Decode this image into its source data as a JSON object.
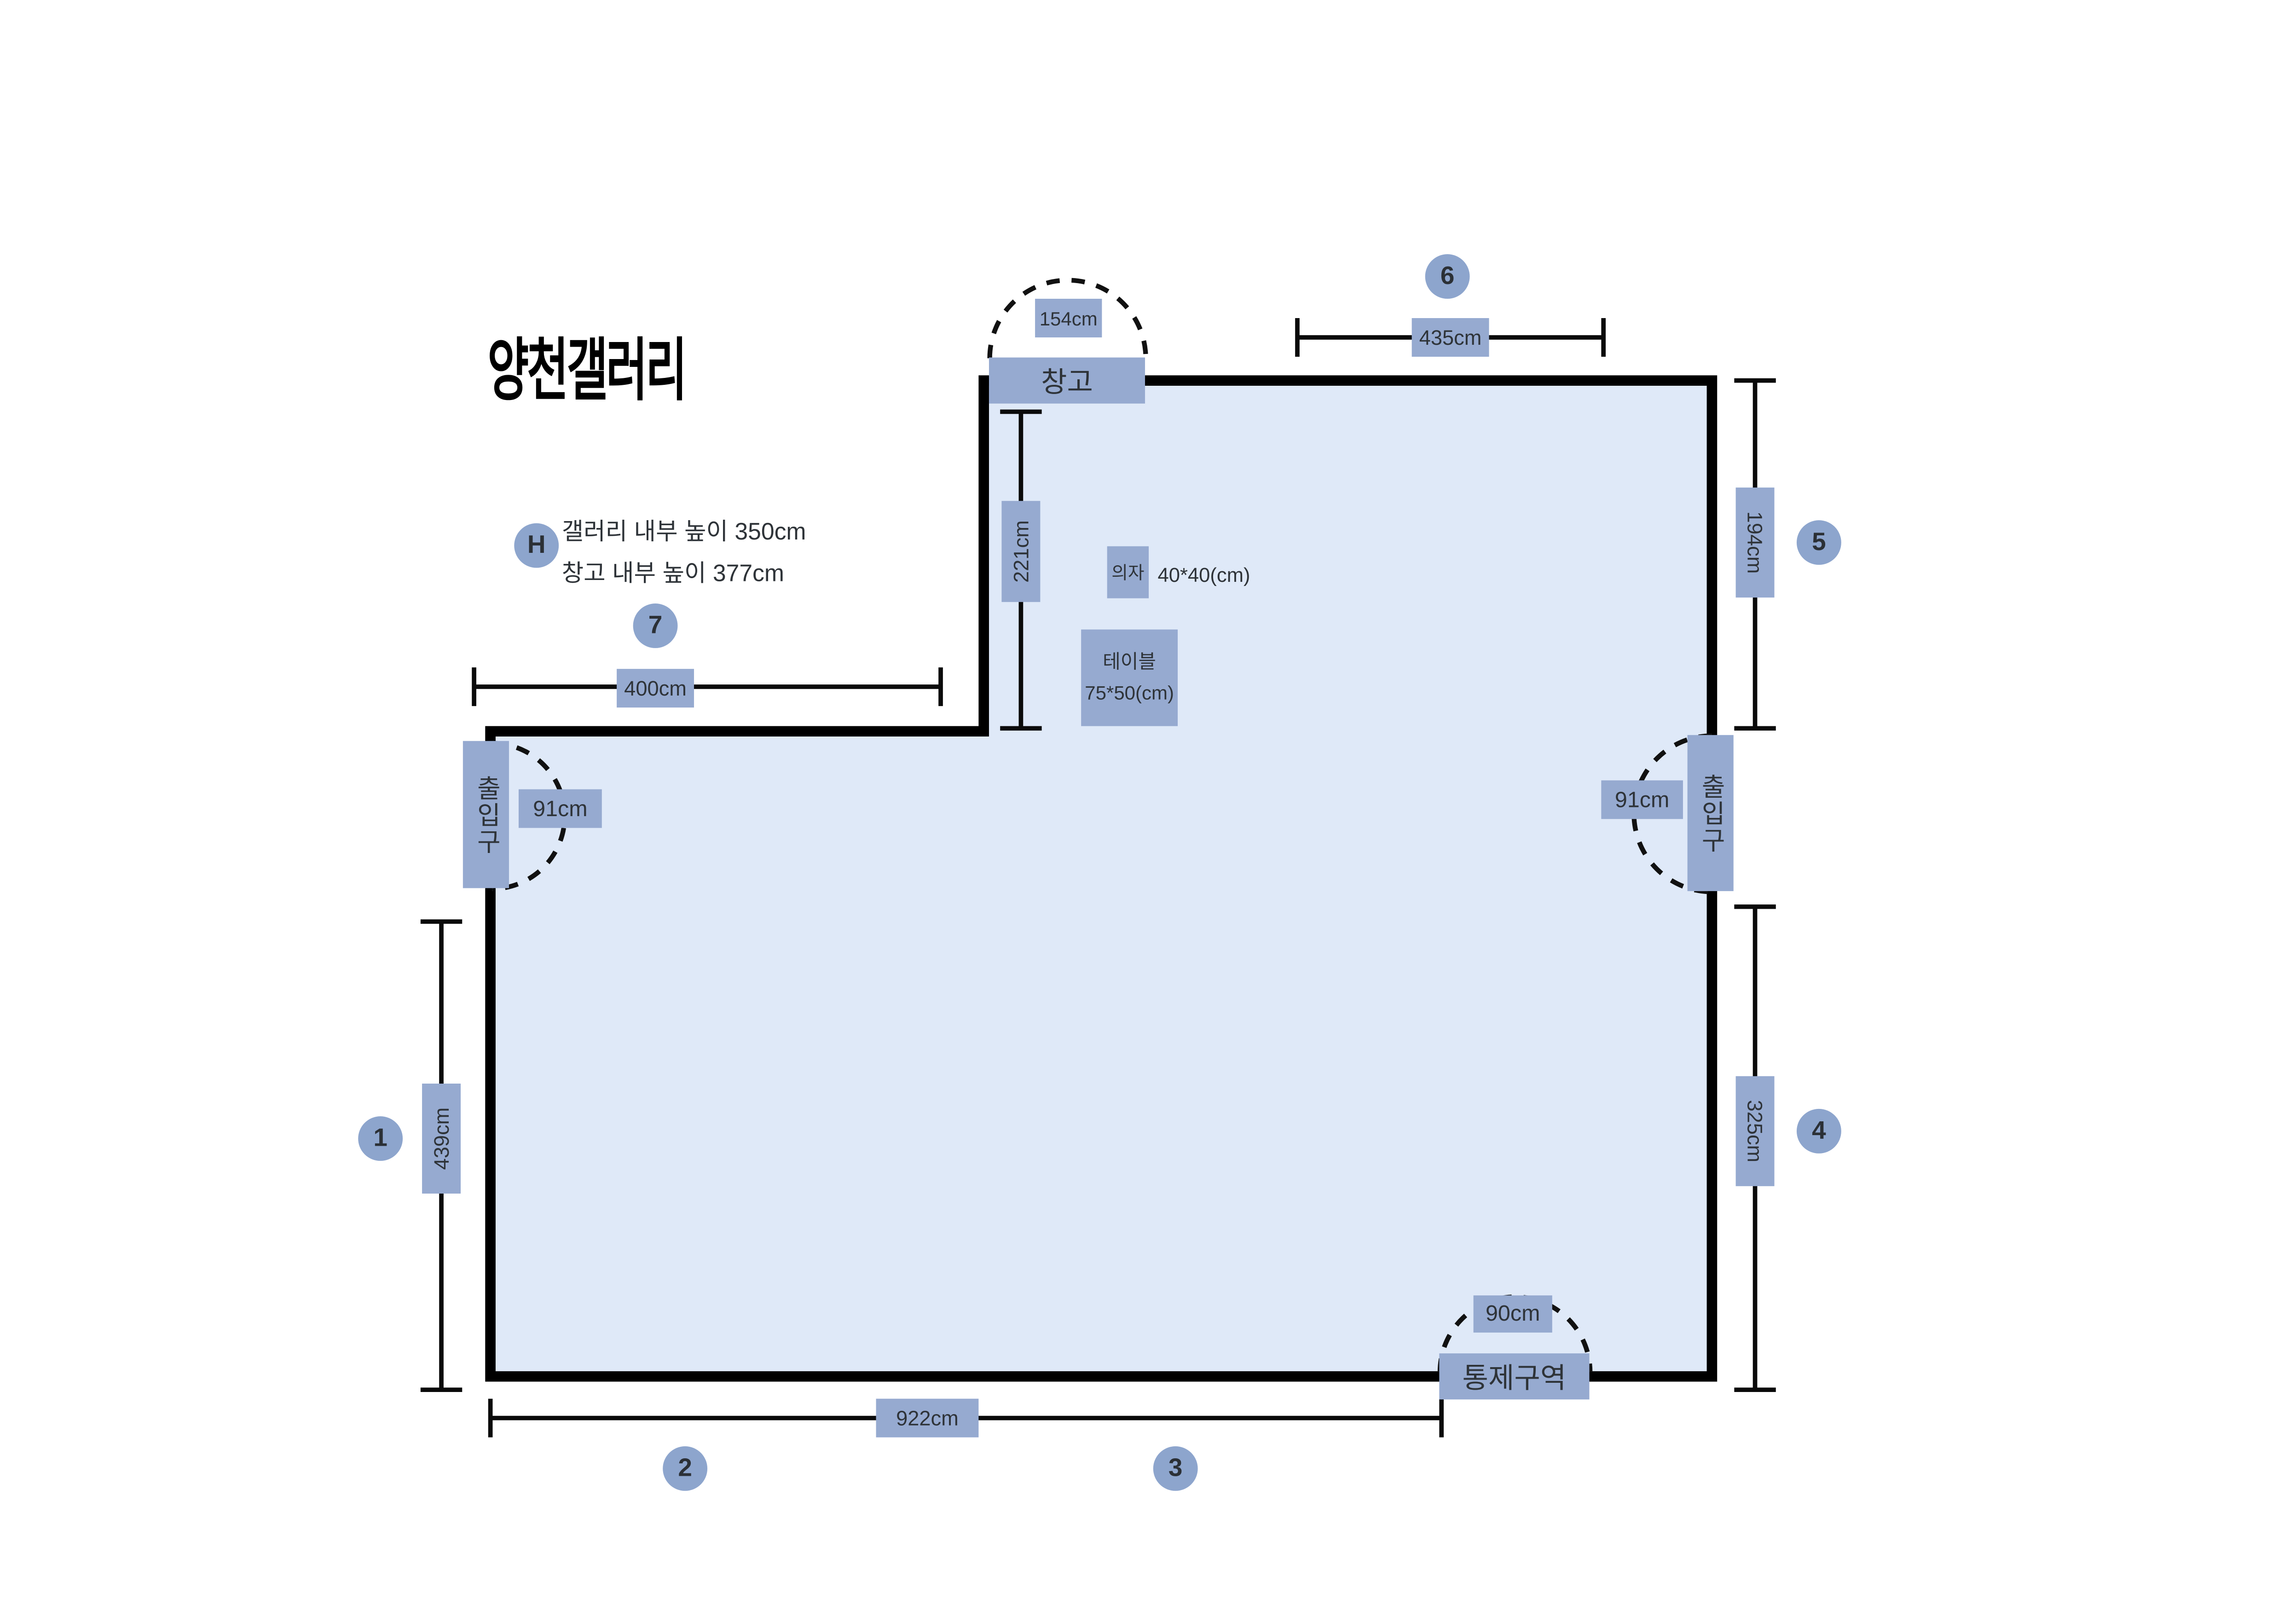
{
  "title": "양천갤러리",
  "legend": {
    "badge": "H",
    "line1": "갤러리 내부 높이 350cm",
    "line2": "창고 내부 높이 377cm"
  },
  "labels": {
    "storage": "창고",
    "entrance_left": "출입구",
    "entrance_right": "출입구",
    "restricted": "통제구역",
    "chair": "의자",
    "chair_size": "40*40(cm)",
    "table": "테이블",
    "table_size": "75*50(cm)"
  },
  "dimensions": {
    "storage_door": "154cm",
    "top_right_wall": "435cm",
    "right_upper_wall": "194cm",
    "inner_wall": "221cm",
    "top_left_wall": "400cm",
    "entrance_left_door": "91cm",
    "entrance_right_door": "91cm",
    "left_wall": "439cm",
    "bottom_wall": "922cm",
    "right_lower_wall": "325cm",
    "restricted_door": "90cm"
  },
  "markers": {
    "wall1": "1",
    "wall2": "2",
    "wall3": "3",
    "wall4": "4",
    "wall5": "5",
    "wall6": "6",
    "wall7": "7"
  },
  "colors": {
    "interior": "#dfe9f8",
    "label_box": "#96aad0",
    "badge": "#8da5cd",
    "wall": "#000000",
    "text_dark": "#2e3338"
  }
}
